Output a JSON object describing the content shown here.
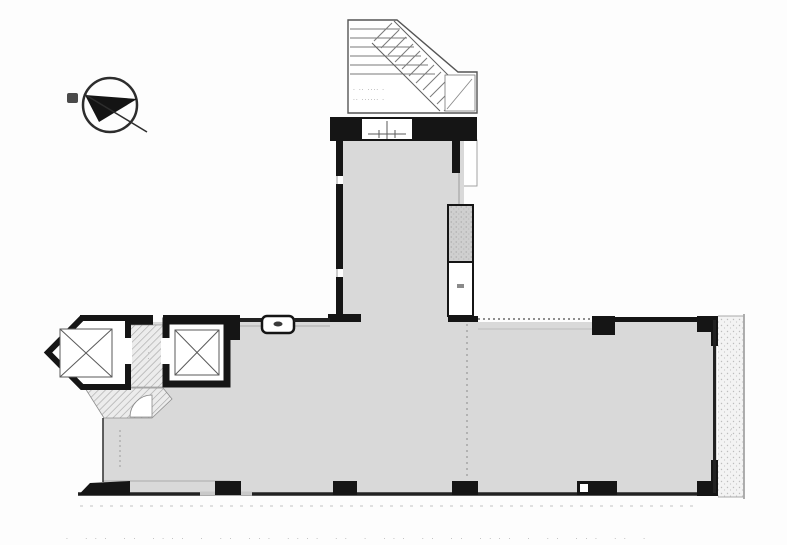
{
  "document": {
    "type": "architectural-floor-plan",
    "description": "T-shaped office floor plan with stair core, two elevators, entrance bay and balcony"
  },
  "colors": {
    "wall": "#161616",
    "room_fill": "#d9d9d9",
    "hall_fill": "#ececec",
    "hatch_line": "#a9a9a9",
    "outline": "#4a4a4a",
    "faint": "#b3b3b3",
    "background": "#fdfdfd"
  },
  "compass": {
    "symbol": "north-arrow"
  },
  "stairs": {
    "label_line1": "· ·· ···· ·",
    "label_line2": "·· ······ ·",
    "treads": 6,
    "diagonal_treads": 11
  },
  "elevator_left": {
    "symbol": "X"
  },
  "elevator_right": {
    "symbol": "X"
  },
  "elevator_hall": {
    "note": "· · ·"
  },
  "balcony": {
    "note": "· ·"
  },
  "caption": {
    "dots": "· ··· ·· ···· · ·· ··· ···· ·· · ··· ·· ·· ···· · ·· ··· ·· ·"
  }
}
